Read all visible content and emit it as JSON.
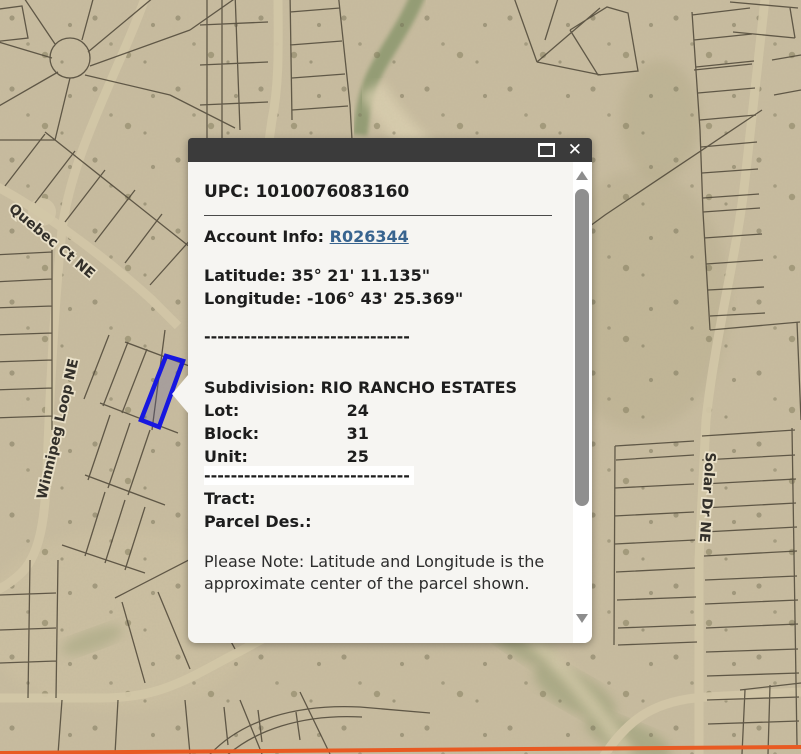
{
  "map": {
    "streets": [
      {
        "name": "Quebec Ct NE"
      },
      {
        "name": "Winnipeg Loop NE"
      },
      {
        "name": "Solar Dr NE"
      }
    ],
    "colors": {
      "terrain": "#c8bc9f",
      "parcel_lines": "#4e4637",
      "selected_parcel_outline": "#1717e0",
      "highlighted_road": "#e85a22"
    }
  },
  "popup": {
    "upc": {
      "label": "UPC:",
      "value": "1010076083160"
    },
    "account": {
      "label": "Account Info:",
      "link": "R026344",
      "link_color": "#38648f"
    },
    "latitude": {
      "label": "Latitude:",
      "value": "35° 21' 11.135\""
    },
    "longitude": {
      "label": "Longitude:",
      "value": "-106° 43' 25.369\""
    },
    "separator": "-------------------------------",
    "subdivision": {
      "label": "Subdivision:",
      "value": "RIO RANCHO ESTATES"
    },
    "lot": {
      "label": "Lot:",
      "value": "24"
    },
    "block": {
      "label": "Block:",
      "value": "31"
    },
    "unit": {
      "label": "Unit:",
      "value": "25"
    },
    "tract": {
      "label": "Tract:",
      "value": ""
    },
    "parcel_des": {
      "label": "Parcel Des.:",
      "value": ""
    },
    "note": "Please Note: Latitude and Longitude is the approximate center of the parcel shown.",
    "close_icon": "✕"
  }
}
